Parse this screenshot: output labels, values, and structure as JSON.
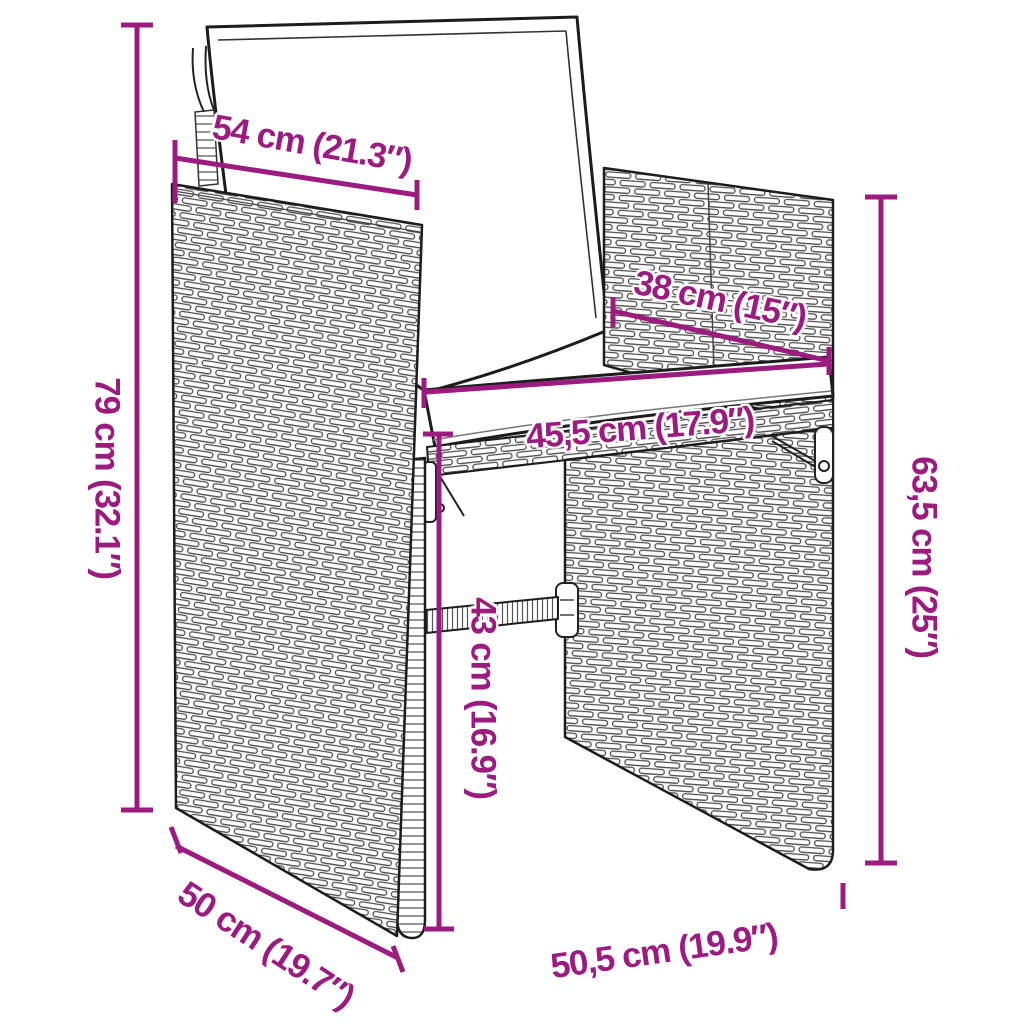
{
  "page": {
    "background_color": "#ffffff"
  },
  "illustration": {
    "name": "rattan-armchair-with-cushions-line-art",
    "stroke_color": "#1c1c1c",
    "weave_color": "#4d4d4d"
  },
  "annotations": {
    "accent_color": "#9B1C7E",
    "dimensions": [
      {
        "id": "backrest-top-width",
        "label": "54 cm (21.3″)"
      },
      {
        "id": "backrest-inner-width",
        "label": "38 cm (15″)"
      },
      {
        "id": "seat-width",
        "label": "45,5 cm (17.9″)"
      },
      {
        "id": "total-height",
        "label": "79 cm (32.1″)"
      },
      {
        "id": "side-height",
        "label": "63,5 cm (25″)"
      },
      {
        "id": "seat-height",
        "label": "43 cm (16.9″)"
      },
      {
        "id": "side-depth",
        "label": "50 cm (19.7″)"
      },
      {
        "id": "front-width",
        "label": "50,5 cm (19.9″)"
      }
    ]
  }
}
